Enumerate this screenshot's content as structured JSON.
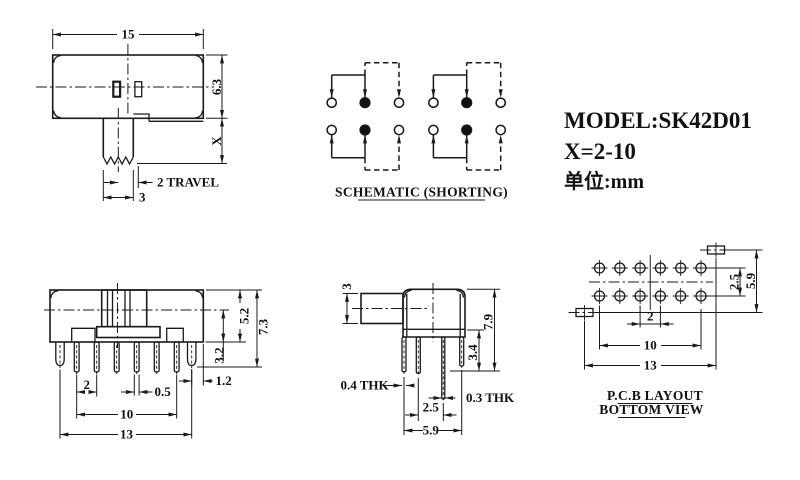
{
  "title_block": {
    "model": "MODEL:SK42D01",
    "x_range": "X=2-10",
    "units": "单位:mm"
  },
  "schematic": {
    "caption": "SCHEMATIC (SHORTING)"
  },
  "top_view": {
    "dim_width": "15",
    "dim_height": "6.3",
    "dim_stem_len": "X",
    "dim_travel": "2 TRAVEL",
    "dim_stem_width": "3"
  },
  "front_view": {
    "dim_body_h": "5.2",
    "dim_total_h": "7.3",
    "dim_pin_len": "3.2",
    "dim_leg_edge": "1.2",
    "dim_pitch": "2",
    "dim_pin_w": "0.5",
    "dim_span": "10",
    "dim_width": "13"
  },
  "side_view": {
    "dim_knob": "3",
    "dim_total": "7.9",
    "dim_pin": "3.4",
    "dim_thk_actuator": "0.4 THK",
    "dim_thk_pin": "0.3 THK",
    "dim_row_pitch": "2.5",
    "dim_depth": "5.9"
  },
  "pcb": {
    "caption_line1": "P.C.B LAYOUT",
    "caption_line2": "BOTTOM VIEW",
    "dim_row_pitch": "2.5",
    "dim_height": "5.9",
    "dim_pitch": "2",
    "dim_span": "10",
    "dim_width": "13"
  },
  "colors": {
    "line": "#1a1a1a",
    "background": "#ffffff"
  }
}
